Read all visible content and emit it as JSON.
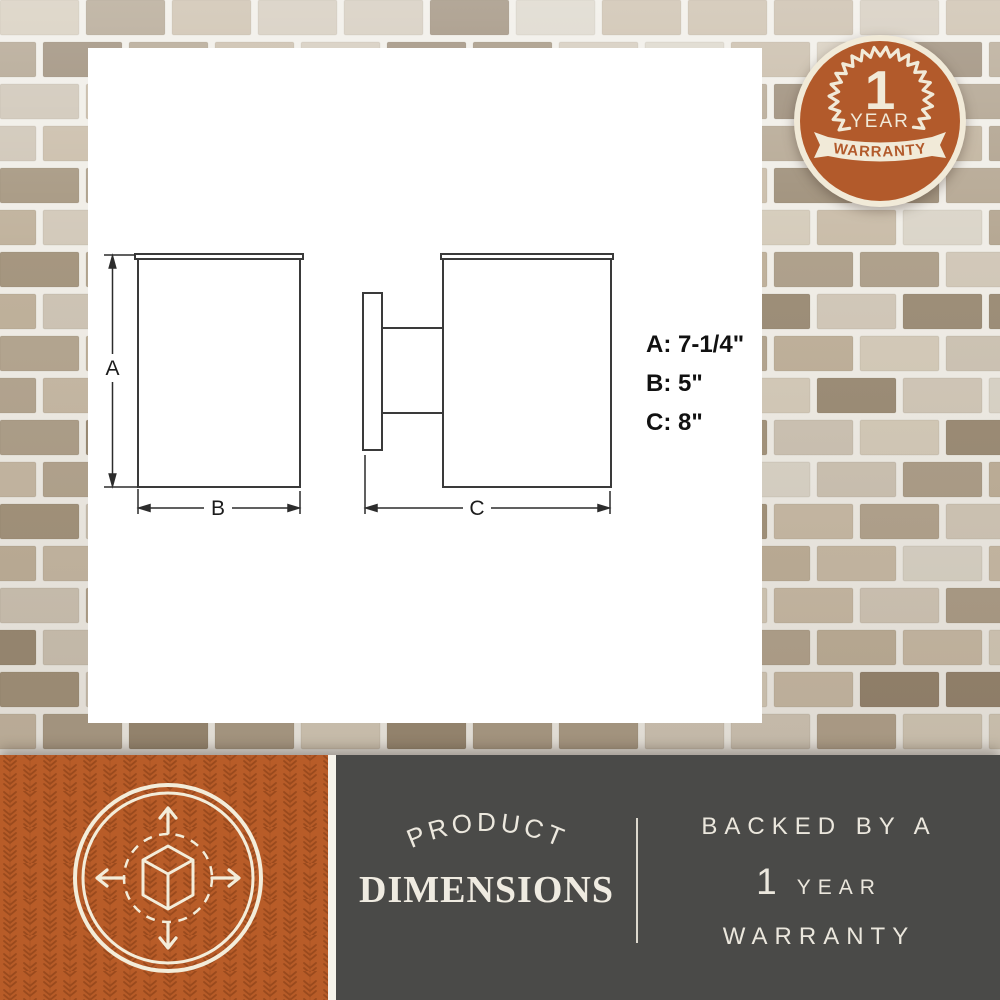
{
  "warranty_badge": {
    "number": "1",
    "year_label": "YEAR",
    "warranty_label": "WARRANTY"
  },
  "diagram": {
    "label_a": "A",
    "label_b": "B",
    "label_c": "C",
    "dimension_values": {
      "a": "A: 7-1/4\"",
      "b": "B: 5\"",
      "c": "C: 8\""
    }
  },
  "banner": {
    "product_label": "PRODUCT",
    "dimensions_label": "DIMENSIONS",
    "backed_by": "BACKED BY A",
    "year_number": "1",
    "year_word": "YEAR",
    "warranty_word": "WARRANTY"
  },
  "icons": {
    "badge": "circular-seal-warranty-badge",
    "cube": "3d-cube-expand-arrows-icon"
  },
  "colors": {
    "badge_orange": "#b25a2b",
    "panel_orange": "#b85c28",
    "pattern_orange": "#9a4a1d",
    "cream": "#f1ead8",
    "dark_gray": "#4a4a48",
    "drawing_line": "#3a3a3a"
  }
}
